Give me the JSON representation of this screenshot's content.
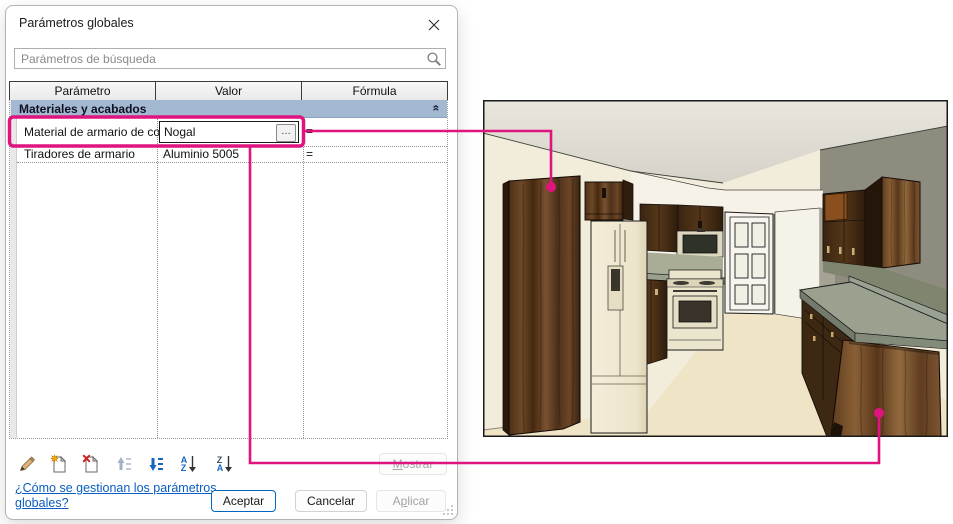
{
  "window": {
    "title": "Parámetros globales"
  },
  "search": {
    "value": "Parámetros de búsqueda"
  },
  "table": {
    "columns": [
      "Parámetro",
      "Valor",
      "Fórmula"
    ],
    "group_header": "Materiales y acabados",
    "rows": [
      {
        "param": "Material de armario de co",
        "value": "Nogal",
        "formula": "="
      },
      {
        "param": "Tiradores de armario",
        "value": "Aluminio 5005",
        "formula": "="
      }
    ]
  },
  "icons": {
    "collapse_glyph": "«",
    "ellipsis": "…",
    "sort_asc": {
      "top": "A",
      "bottom": "Z"
    },
    "sort_desc": {
      "top": "Z",
      "bottom": "A"
    },
    "names": [
      "edit-icon",
      "new-parameter-icon",
      "delete-parameter-icon",
      "move-up-icon",
      "move-down-icon",
      "sort-ascending-icon",
      "sort-descending-icon",
      "search-icon",
      "close-icon"
    ]
  },
  "buttons": {
    "mostrar": {
      "key": "M",
      "post": "ostrar"
    },
    "aceptar": "Aceptar",
    "cancelar": "Cancelar",
    "aplicar": {
      "pre": "A",
      "key": "p",
      "post": "licar"
    }
  },
  "help_link": "¿Cómo se gestionan los parámetros globales?",
  "annotation": {
    "color": "#e0147f"
  }
}
